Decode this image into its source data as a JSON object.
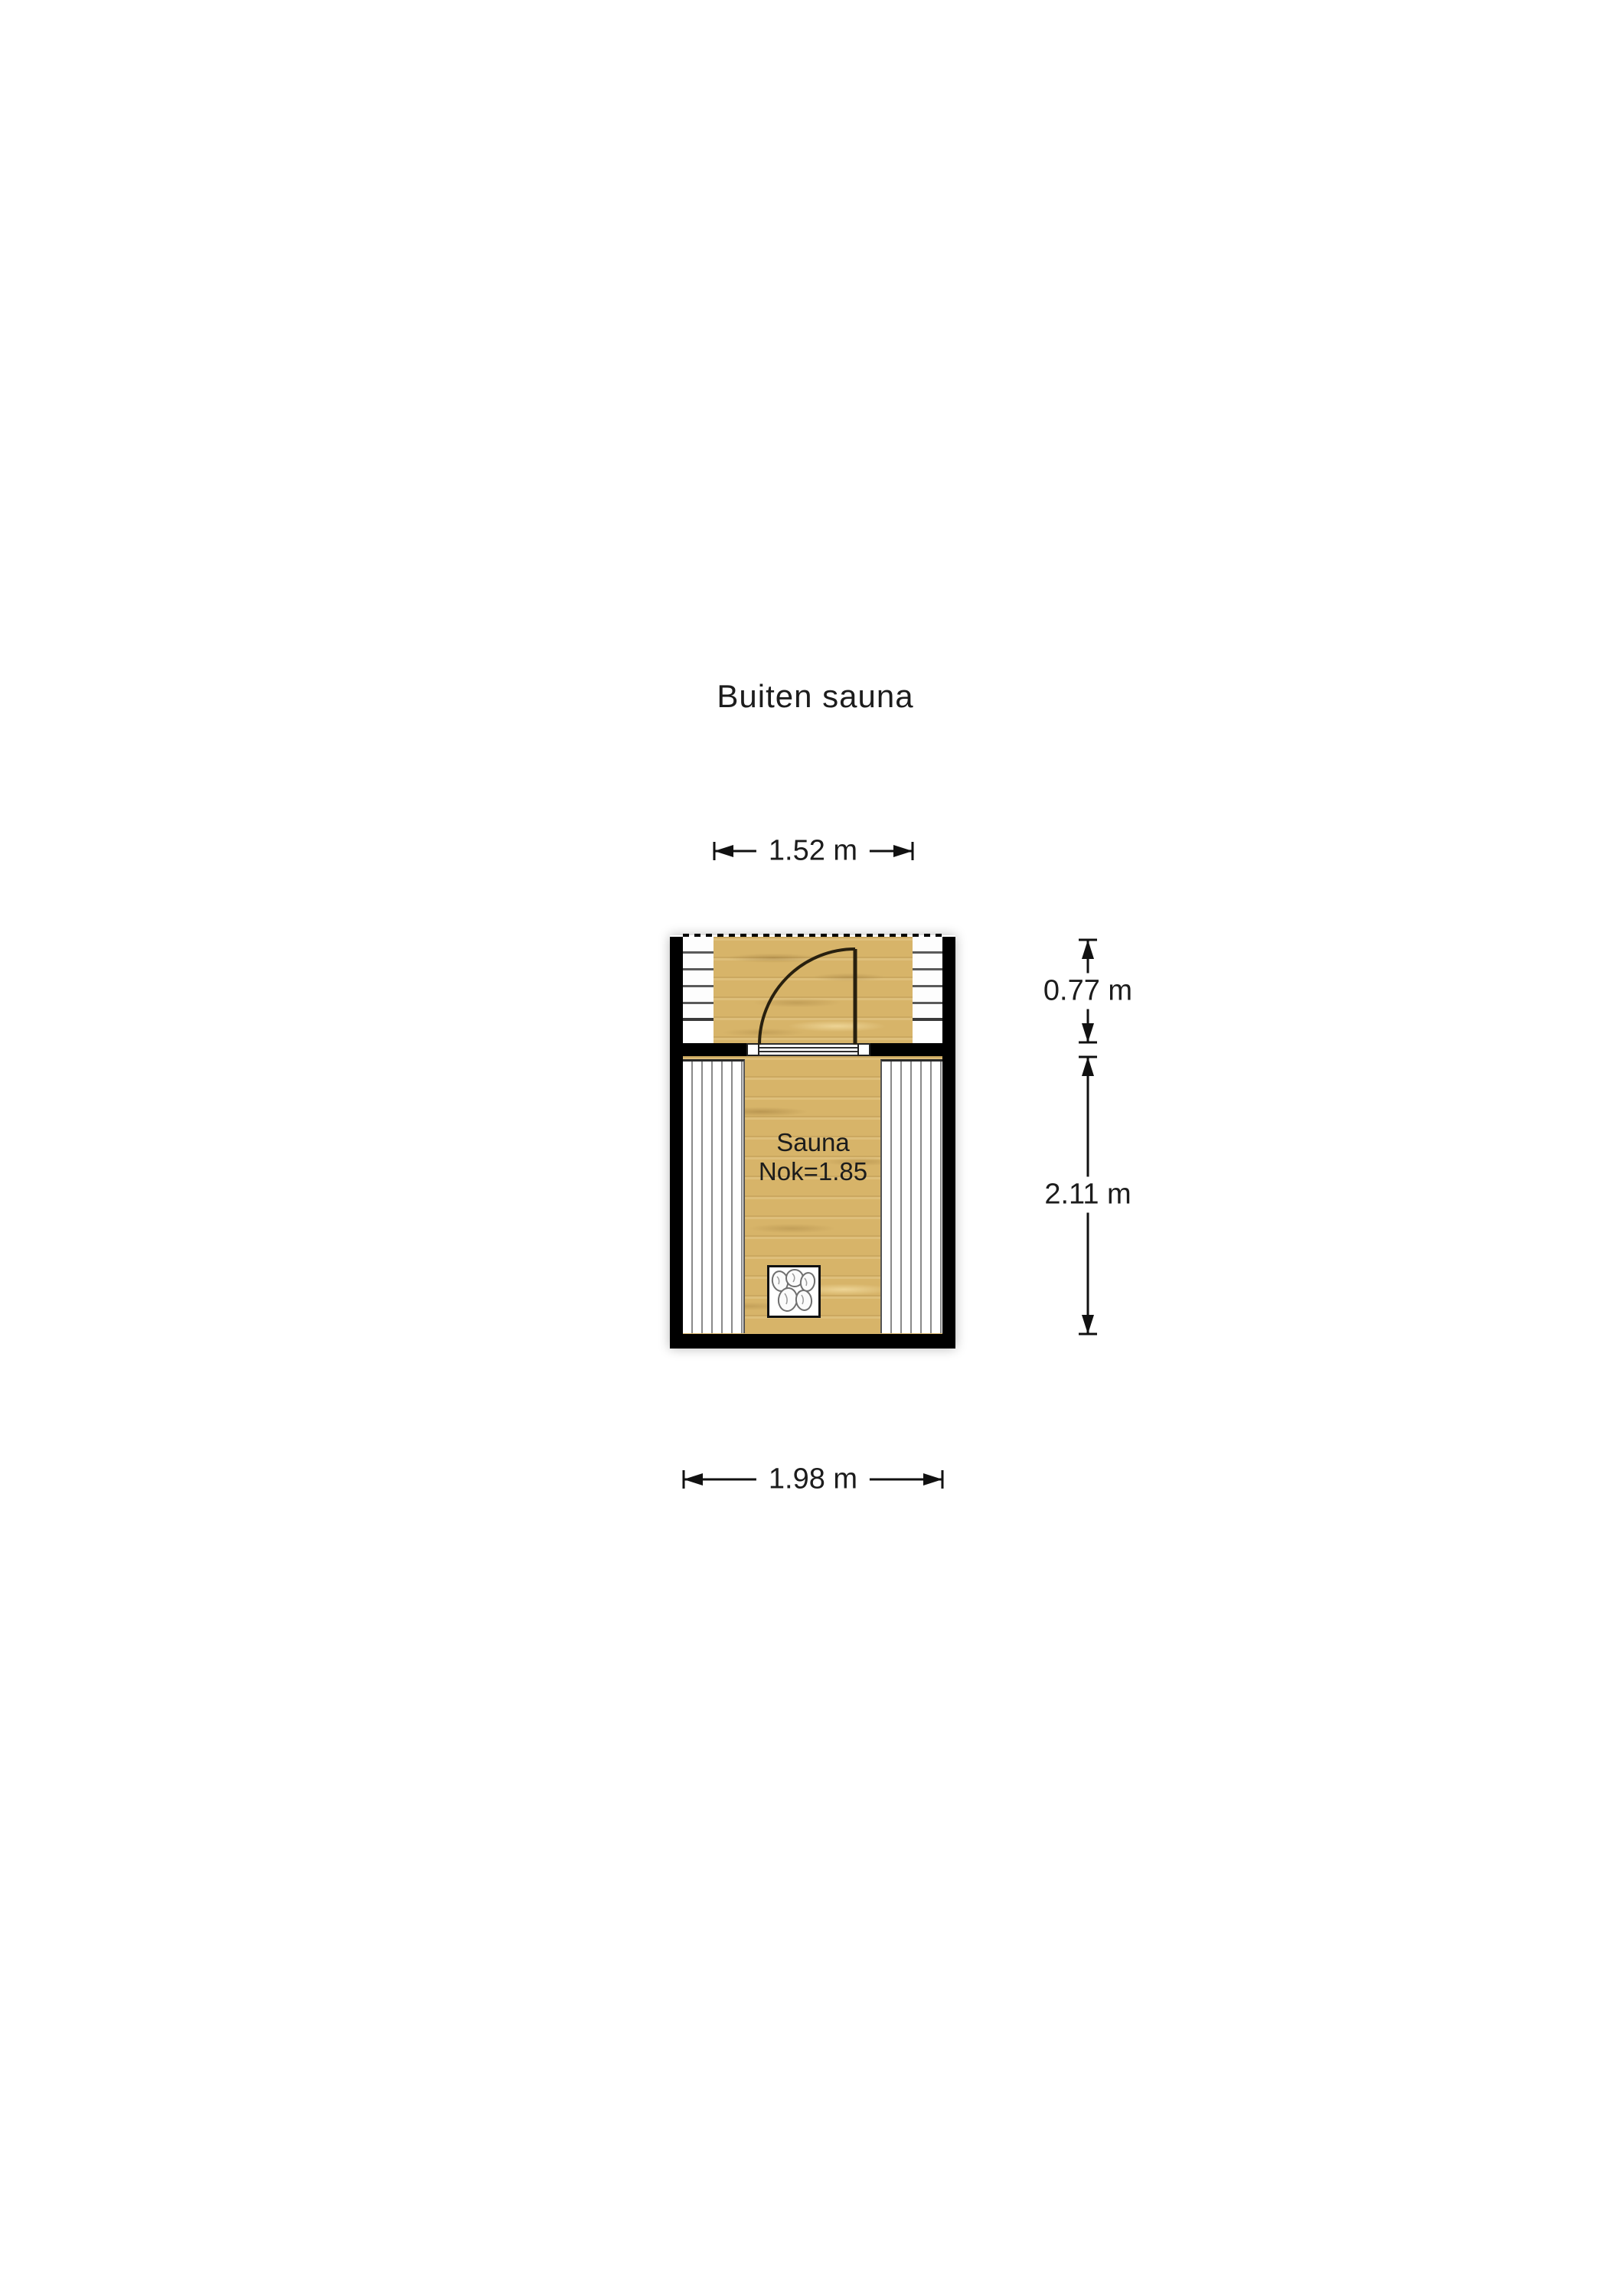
{
  "title": "Buiten sauna",
  "plan": {
    "room": {
      "label": "Sauna",
      "ridge_height": "Nok=1.85"
    },
    "dimensions": {
      "deck_width": "1.52 m",
      "outer_width": "1.98 m",
      "porch_depth": "0.77 m",
      "room_depth": "2.11 m"
    },
    "colors": {
      "wall": "#000000",
      "wood": "#d7b469",
      "line": "#111111",
      "background": "#ffffff"
    }
  }
}
